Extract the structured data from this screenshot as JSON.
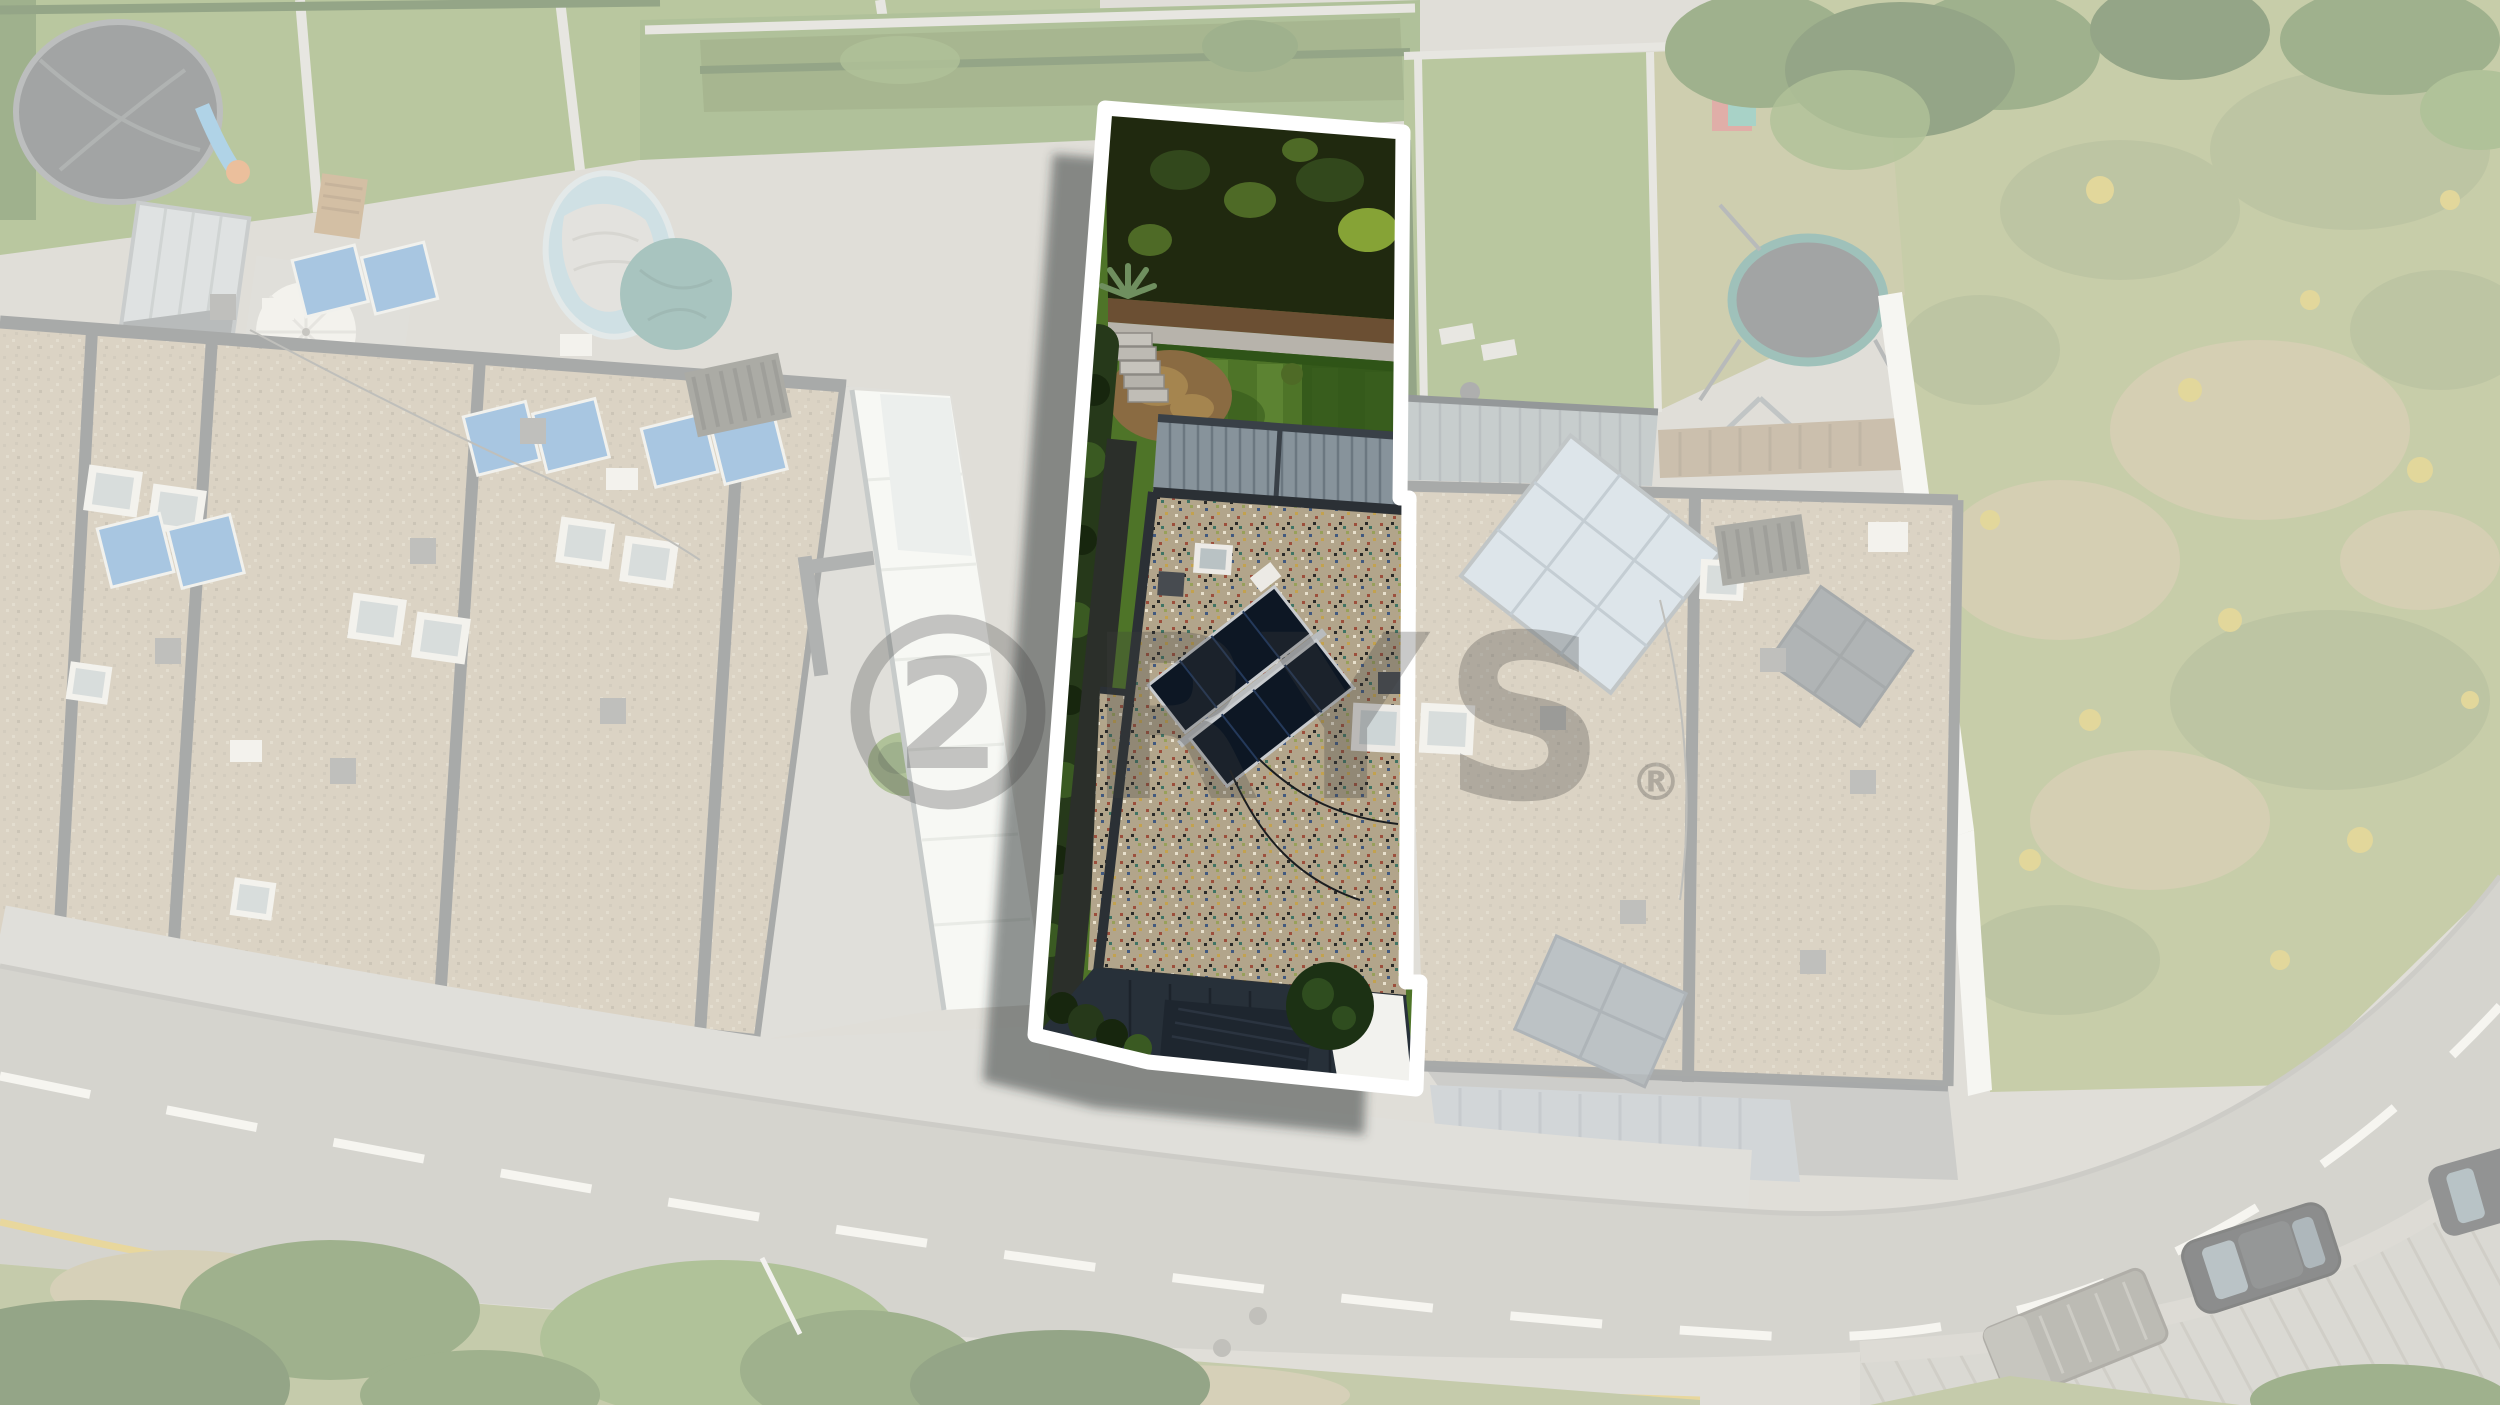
{
  "watermark": {
    "logo_glyph": "2",
    "text": "RYS",
    "registered_mark": "®",
    "opacity": "0.28"
  },
  "parcel": {
    "points": "1105,108 1403,132 1400,498 1409,498 1406,982 1420,982 1416,1089 1148,1062 1035,1035",
    "shadow_dx": "-52",
    "shadow_dy": "46"
  },
  "colors": {
    "base": "#c8c5be",
    "veil": "#fbfaf7",
    "outline": "#ffffff",
    "shadow": "rgba(45,48,52,0.5)",
    "watermark": "#3f3f3f",
    "lawnN": "#7f9a52",
    "lawnN2": "#6f8f48",
    "meadow": "#9aa465",
    "meadowDark": "#87955a",
    "meadowDry": "#b3a878",
    "flowerYellow": "#cdb84a",
    "treeN": "#4e7030",
    "treeNDark": "#3a5a24",
    "treeNLight": "#6f9046",
    "roofN": "#bfb098",
    "roofNDot1": "#b0a28c",
    "roofNDot2": "#cfc2ac",
    "roofNDot3": "#a3957f",
    "parapetN": "#5f6265",
    "wallLight": "#d6d4cf",
    "wallWhite": "#f2f2ee",
    "canopyWhite": "#f4f5f2",
    "canopyGrid": "#d9ddd8",
    "court": "#c9c7c0",
    "facade": "#b4b3af",
    "facadeLight": "#d2d1cd",
    "facadeDark": "#6e7174",
    "brick": "#b9b8b3",
    "roadAsphalt": "#b3b1ab",
    "sidewalk": "#c9c7c1",
    "curb": "#a5a39d",
    "roadDash": "#f1f0ea",
    "roadYellow": "#d8b84e",
    "manhole": "#8f8d86",
    "vergeGrass": "#96a168",
    "vergeDry": "#b5ab80",
    "parkingPaver": "#bebbb3",
    "parkingLine": "#aaa79e",
    "carDark": "#2b2d30",
    "carGlass": "#8fa4ae",
    "carRoof": "#3c3f42",
    "binGray": "#85827a",
    "solarThermal": "#5f97cf",
    "solarFadedBlue": "#c3d2df",
    "solarFadedGrid": "#93a5b3",
    "solarMidGray": "#6e767c",
    "hvacWhite": "#eceae5",
    "ventGray": "#8b8b88",
    "grateGray": "#64645e",
    "metalCanopyN": "#9aa4a9",
    "metalSeamN": "#828d93",
    "rampBlue": "#aeb5bd",
    "rampLine": "#99a1aa",
    "poolBlue": "#a9c8d4",
    "poolCover": "#cfcdc8",
    "tarpTeal": "#5f948e",
    "trampolineGray": "#54585b",
    "trampolineTeal": "#4f8f84",
    "bedDark": "#20290f",
    "bushDark": "#32481c",
    "bushMid": "#4e6a26",
    "bushLight": "#86a336",
    "mulch": "#6b4f33",
    "wallTop": "#b7b3ab",
    "lawn": "#4e7428",
    "lawnStripe": "#648c38",
    "lawnShade": "#2f5418",
    "treeDry": "#8a6b42",
    "treeDryLight": "#a5854f",
    "hedge": "#26391a",
    "hedgeDark": "#17260e",
    "hedgeLight": "#3a5a22",
    "pathDark": "#2b2f2a",
    "canopyMetal": "#87939b",
    "canopySeam": "#6b7780",
    "canopyEdge": "#394047",
    "gravel": "#b2a58b",
    "gravelRed": "#9c4f3c",
    "gravelBlue": "#41597f",
    "gravelTeal": "#3f7464",
    "gravelYellow": "#c3a24e",
    "gravelWhite": "#e8e0cc",
    "gravelBlack": "#2a2a28",
    "gravelGreen": "#97a05a",
    "parapet": "#2b3035",
    "solarDark": "#0d1724",
    "solarCell": "#24395a",
    "solarFrame": "#c8cbce",
    "skylightFrame": "#eceae6",
    "skylightGlass": "#b9c2c4",
    "ventDark": "#474b50",
    "paversNight": "#273039",
    "paversJoint": "#1c232b",
    "garageDoor": "#1e262f",
    "treeGreen": "#1c3114",
    "treeGreenLight": "#2f4d1f",
    "wireDark": "#1a1d20"
  }
}
